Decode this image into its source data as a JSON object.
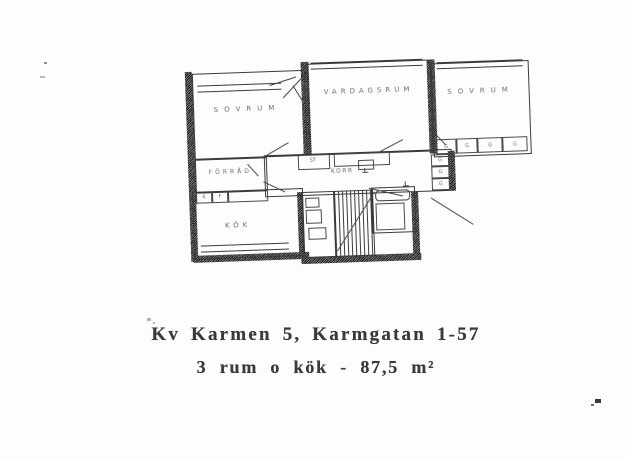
{
  "plan": {
    "rooms": {
      "bedroom_left": "SOVRUM",
      "living_room": "VARDAGSRUM",
      "bedroom_right": "SOVRUM",
      "storage": "FÖRRÅD",
      "hall": "KORR",
      "kitchen": "KÖK",
      "cleaning_closet": "ST"
    },
    "wardrobe_row_labels": [
      "G",
      "G",
      "G",
      "G"
    ],
    "hall_stack_labels": [
      "G",
      "G",
      "G"
    ],
    "kitchen_unit_labels": [
      "K",
      "F"
    ],
    "ink_color": "#3b3a38"
  },
  "caption": {
    "line1": "Kv Karmen 5, Karmgatan 1-57",
    "line2": "3 rum o kök - 87,5 m²"
  }
}
